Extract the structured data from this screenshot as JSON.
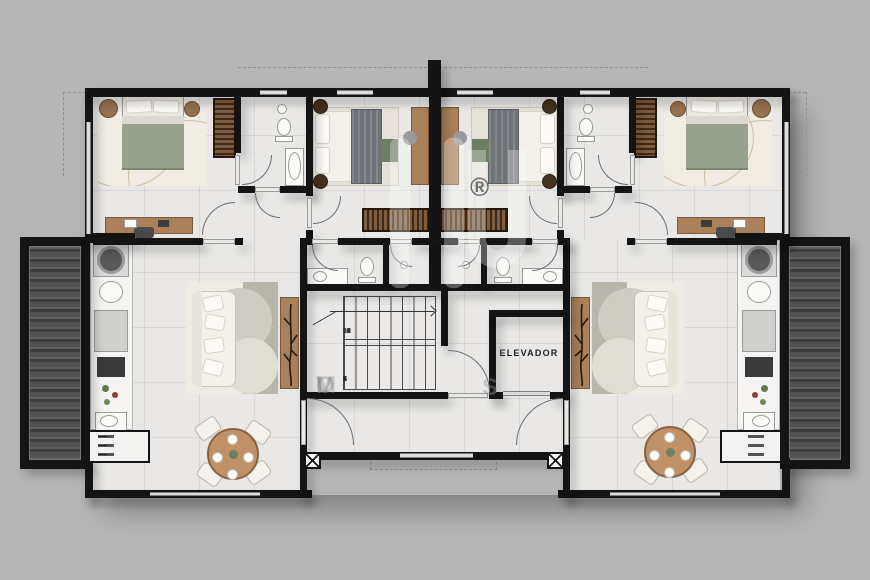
{
  "plan": {
    "elevator": {
      "label": "ELEVADOR"
    },
    "staircase": {
      "upper_flight_numbers": [
        "9",
        "10",
        "11",
        "12",
        "13",
        "14",
        "15",
        "16"
      ],
      "lower_flight_numbers": [
        "8",
        "7",
        "6",
        "5",
        "4",
        "3",
        "2",
        "1"
      ]
    },
    "watermark": {
      "registered_symbol": "®",
      "faint_letters": [
        "I",
        "M",
        "O",
        "V"
      ],
      "letter_s": "S"
    }
  },
  "colors": {
    "background": "#b5b5b5",
    "wall": "#141414",
    "floor": "#e9e8e6",
    "deck_dark": "#4e4e4e",
    "wood": "#a9805a",
    "wood_dark": "#6b4d33",
    "bed_green": "#99a28c",
    "blanket_gray": "#6f7277",
    "rug_cream": "#f0ece1",
    "fixture_white": "#fafaf8",
    "plant_green": "#6d7e63",
    "table_wood": "#c09066",
    "dashed_line": "#8f8f8f"
  }
}
